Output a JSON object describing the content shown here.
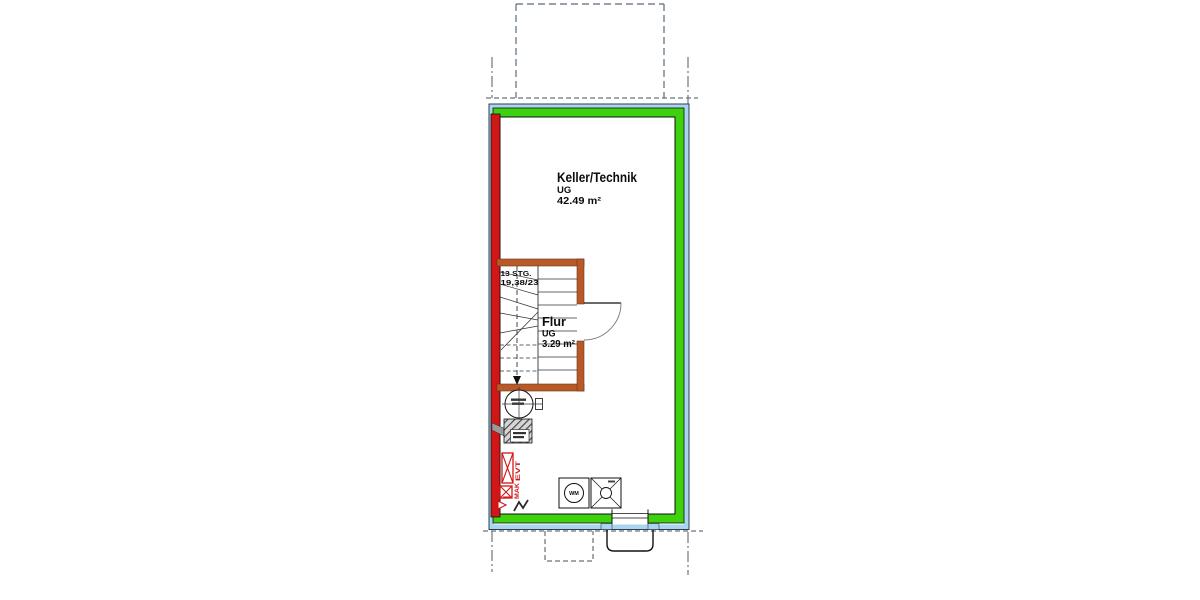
{
  "plan": {
    "rooms": {
      "keller": {
        "name": "Keller/Technik",
        "level": "UG",
        "area": "42.49 m²"
      },
      "flur": {
        "name": "Flur",
        "level": "UG",
        "area": "3.29 m²"
      }
    },
    "stair": {
      "steps_label": "13 STG.",
      "rise_run_label": "19,38/23"
    },
    "symbols": {
      "washing_machine": "WM",
      "electro_distribution": "EVT",
      "house_connection": "MAK"
    },
    "colors": {
      "exterior_wall_green": "#3ed10e",
      "party_wall_red": "#d01616",
      "stair_enclosure_orange": "#b85a28",
      "insulation_blue": "#a9d6ee",
      "outline_navy": "#2c3e50"
    }
  }
}
